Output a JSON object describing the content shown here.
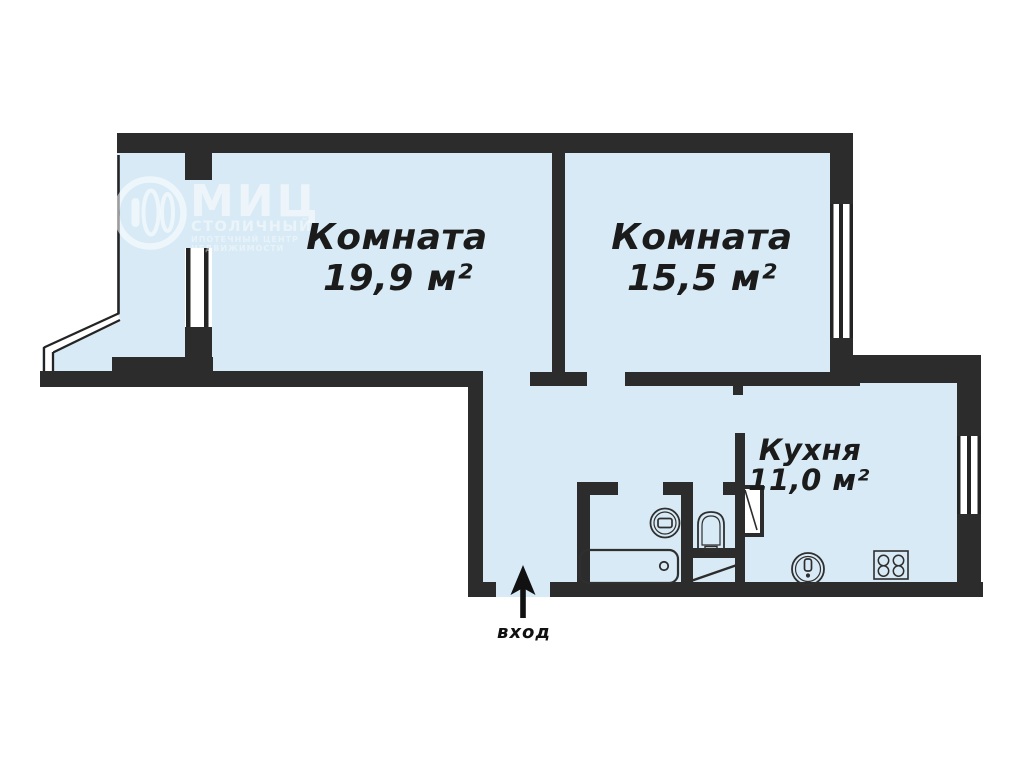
{
  "meta": {
    "document_type": "apartment floor plan",
    "language": "ru"
  },
  "colors": {
    "wall": "#2c2c2c",
    "room_fill": "#d8eaf5",
    "outside": "#ffffff",
    "fixture_outline": "#2f2f2f",
    "label_text": "#1b1b1b",
    "watermark": "#ffffff"
  },
  "rooms": [
    {
      "id": "room1",
      "name": "Комната",
      "area": "19,9 м²"
    },
    {
      "id": "room2",
      "name": "Комната",
      "area": "15,5 м²"
    },
    {
      "id": "kitchen",
      "name": "Кухня",
      "area": "11,0 м²"
    }
  ],
  "entrance": {
    "label": "вход",
    "arrow_direction": "up"
  },
  "watermark": {
    "title": "МИЦ",
    "subtitle": "СТОЛИЧНЫЙ",
    "line3": "ИПОТЕЧНЫЙ ЦЕНТР",
    "line4": "НЕДВИЖИМОСТИ"
  },
  "fixtures": {
    "bathtub": "bathtub-icon",
    "washbasin": "washbasin-icon",
    "toilet": "toilet-icon",
    "kitchen_sink": "kitchen-sink-icon",
    "stove": "stove-icon",
    "entrance_arrow": "entrance-arrow-icon"
  }
}
